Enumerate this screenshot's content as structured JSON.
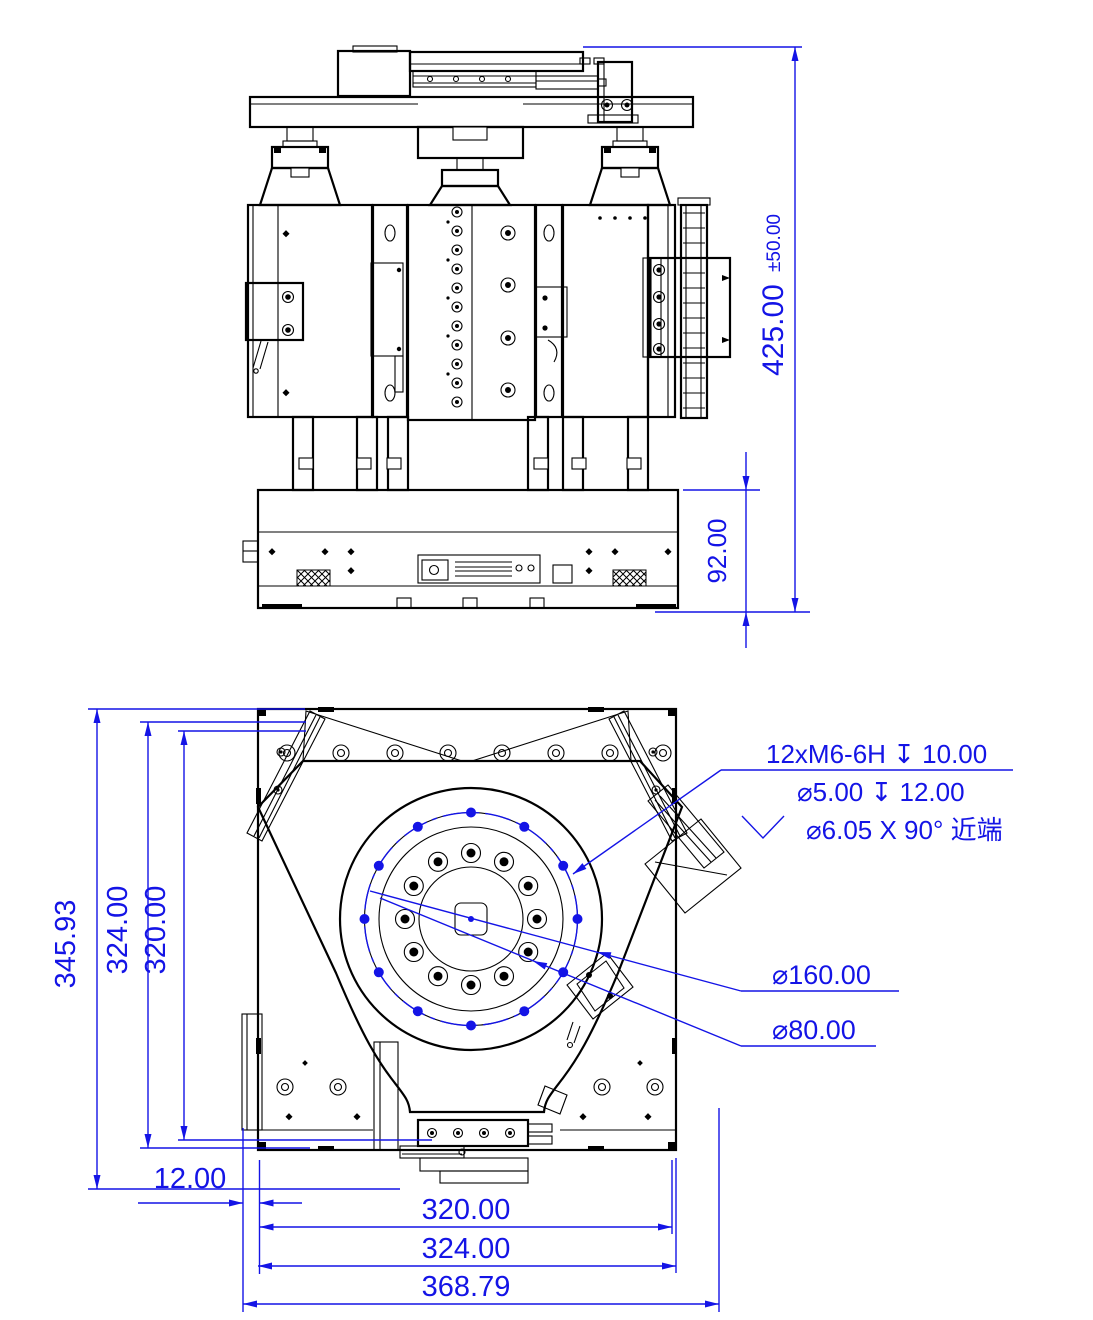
{
  "document": {
    "type": "2-view mechanical engineering drawing of a tripod positioning stage",
    "views": [
      "front elevation",
      "top plan"
    ]
  },
  "colors": {
    "dimension_blue": "#1414e6",
    "line_black": "#000000",
    "background": "#ffffff"
  },
  "front_view": {
    "dimensions": [
      {
        "id": "total-height",
        "value": "425.00",
        "tolerance": "±50.00",
        "orientation": "vertical"
      },
      {
        "id": "base-height",
        "value": "92.00",
        "orientation": "vertical"
      }
    ]
  },
  "top_view": {
    "dimensions": [
      {
        "id": "overall-depth",
        "value": "345.93",
        "orientation": "vertical"
      },
      {
        "id": "plate-depth",
        "value": "324.00",
        "orientation": "vertical"
      },
      {
        "id": "hole-span-depth",
        "value": "320.00",
        "orientation": "vertical"
      },
      {
        "id": "edge-offset",
        "value": "12.00",
        "orientation": "horizontal"
      },
      {
        "id": "hole-span-width",
        "value": "320.00",
        "orientation": "horizontal"
      },
      {
        "id": "plate-width",
        "value": "324.00",
        "orientation": "horizontal"
      },
      {
        "id": "overall-width",
        "value": "368.79",
        "orientation": "horizontal"
      }
    ],
    "callouts": {
      "thread": {
        "line1": "12xM6-6H ↧ 10.00",
        "line2": "⌀5.00 ↧ 12.00",
        "line3": "⌀6.05 X 90° 近端",
        "countersink_symbol": "⌵"
      },
      "bolt_circle": "⌀160.00",
      "center_bore": "⌀80.00"
    }
  }
}
